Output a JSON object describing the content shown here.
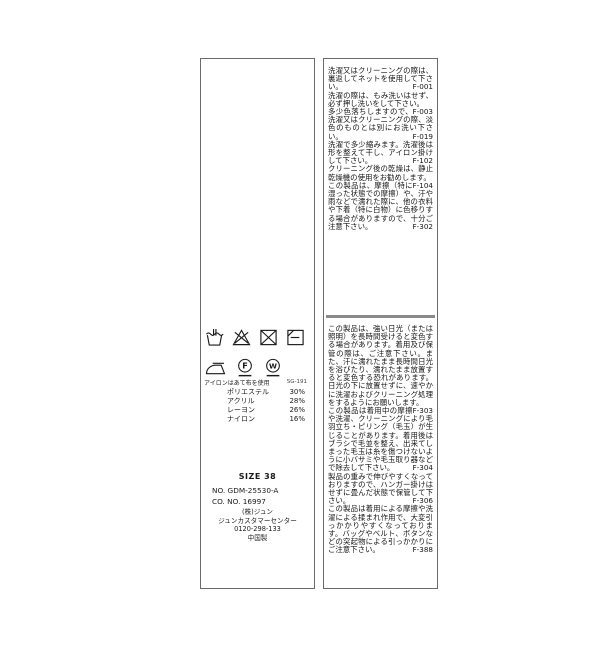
{
  "page": {
    "background": "#ffffff"
  },
  "colors": {
    "label_border": "#6b6b6b",
    "divider": "#8a8a8a",
    "text": "#1a1a1a"
  },
  "left_label": {
    "care_symbols_row1": [
      {
        "name": "hand-wash"
      },
      {
        "name": "do-not-bleach"
      },
      {
        "name": "do-not-tumble-dry"
      },
      {
        "name": "flat-dry-in-shade"
      }
    ],
    "care_symbols_row2": [
      {
        "name": "iron-with-cloth"
      },
      {
        "name": "dry-clean-f-gentle"
      },
      {
        "name": "wet-clean-w-gentle"
      }
    ],
    "iron_note": "アイロンはあて布を使用",
    "lot_number": "SG-191",
    "composition": [
      {
        "name": "ポリエステル",
        "value": "30%"
      },
      {
        "name": "アクリル",
        "value": "28%"
      },
      {
        "name": "レーヨン",
        "value": "26%"
      },
      {
        "name": "ナイロン",
        "value": "16%"
      }
    ],
    "size_label": "SIZE 38",
    "item_no": "NO. GDM-25530-A",
    "co_no": "CO. NO. 16997",
    "company": [
      "(株)ジュン",
      "ジュンカスタマーセンター",
      "0120-298-133",
      "中国製"
    ]
  },
  "right_label": {
    "sections": [
      {
        "items": [
          {
            "text": "洗濯又はクリーニングの際は、裏返してネットを使用して下さい。",
            "code": "F-001"
          },
          {
            "text": "洗濯の際は、もみ洗いはせず、必ず押し洗いをして下さい。",
            "code": "F-003"
          },
          {
            "text": "多少色落ちしますので、洗濯又はクリーニングの際、淡色のものとは別にお洗い下さい。",
            "code": "F-019"
          },
          {
            "text": "洗濯で多少縮みます。洗濯後は形を整えて干し、アイロン掛けして下さい。",
            "code": "F-102"
          },
          {
            "text": "クリーニング後の乾燥は、静止乾燥機の使用をお勧めします。",
            "code": "F-104"
          },
          {
            "text": "この製品は、摩擦（特に湿った状態での摩擦）や、汗や雨などで濡れた際に、他の衣料や下着（特に白物）に色移りする場合がありますので、十分ご注意下さい。",
            "code": "F-302"
          }
        ]
      },
      {
        "items": [
          {
            "text": "この製品は、強い日光（または照明）を長時間受けると変色する場合があります。着用及び保管の際は、ご注意下さい。また、汗に濡れたまま長時間日光を浴びたり、濡れたまま放置すると変色する恐れがあります。日光の下に放置せずに、速やかに洗濯およびクリーニング処理をするようにお願いします。",
            "code": "F-303"
          },
          {
            "text": "この製品は着用中の摩擦や洗濯、クリーニングにより毛羽立ち・ピリング（毛玉）が生じることがあります。着用後はブラシで毛並を整え、出来てしまった毛玉は糸を傷つけないように小バサミや毛玉取り器などで除去して下さい。",
            "code": "F-304"
          },
          {
            "text": "製品の重みで伸びやすくなっておりますので、ハンガー掛けはせずに畳んだ状態で保管して下さい。",
            "code": "F-306"
          },
          {
            "text": "この製品は着用による摩擦や洗濯による揉まれ作用で、大変引っかかりやすくなっております。バッグやベルト、ボタンなどの突起物による引っかかりにご注意下さい。",
            "code": "F-388"
          }
        ]
      }
    ]
  }
}
